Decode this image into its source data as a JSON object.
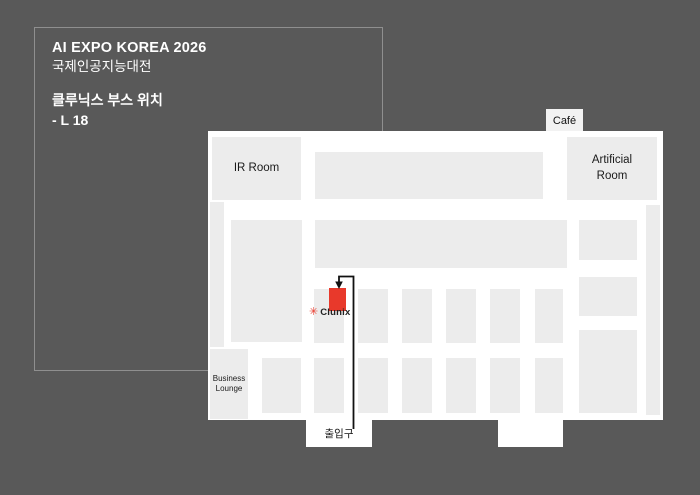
{
  "info_panel": {
    "title": "AI EXPO KOREA 2026",
    "subtitle": "국제인공지능대전",
    "booth_location_label": "클루닉스 부스 위치",
    "booth_number": "- L 18"
  },
  "map": {
    "rooms": {
      "ir_room": "IR Room",
      "artificial_room": "Artificial Room",
      "business_lounge": "Business Lounge",
      "cafe": "Café"
    },
    "entrance_label": "출입구",
    "booth": {
      "company": "Clunix",
      "logo_icon": "asterisk-flower-icon",
      "booth_marker": "red-rectangle"
    }
  },
  "colors": {
    "background": "#595959",
    "floor": "#ffffff",
    "block_gray": "#ececec",
    "booth_highlight": "#e8392b",
    "path_line": "#111111",
    "panel_border": "#8f8f8f",
    "panel_text": "#ffffff",
    "map_text": "#1a1a1a"
  }
}
